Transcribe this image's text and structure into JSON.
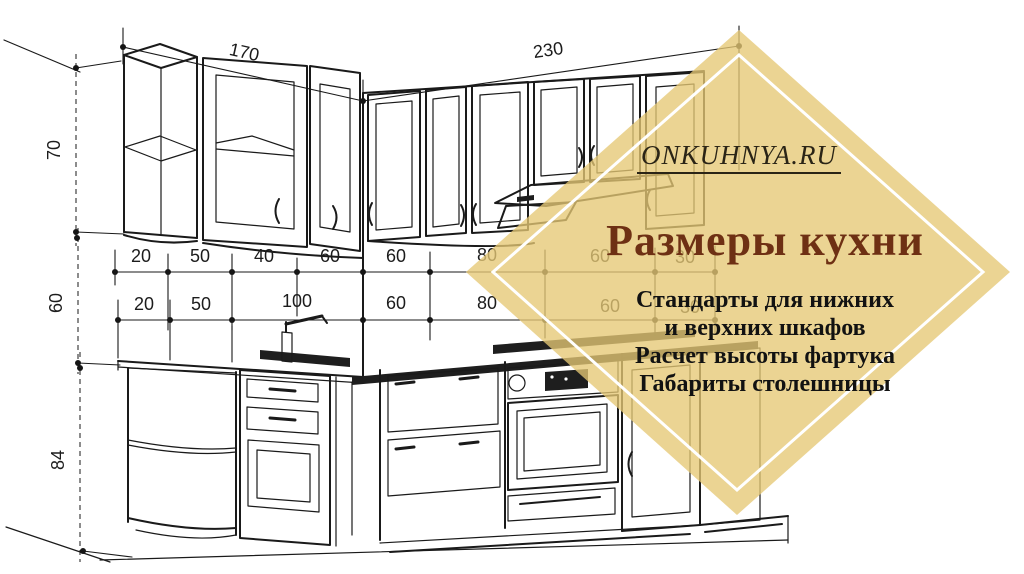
{
  "diagram": {
    "ink": "#1a1a1a",
    "top": [
      "170",
      "230"
    ],
    "left": [
      "70",
      "60",
      "84"
    ],
    "row_upper": [
      "20",
      "50",
      "40",
      "60",
      "60",
      "80",
      "60",
      "30"
    ],
    "row_lower": [
      "20",
      "50",
      "100",
      "60",
      "80",
      "60",
      "30"
    ]
  },
  "overlay": {
    "site": "ONKUHNYA.RU",
    "title": "Размеры кухни",
    "lines": [
      "Стандарты для нижних",
      "и верхних шкафов",
      "Расчет высоты фартука",
      "Габариты столешницы"
    ],
    "fill": "#e6c875",
    "fill_opacity": "0.78",
    "border": "#ffffff",
    "title_color": "#6e3014",
    "site_color": "#2a2416",
    "text_color": "#121212"
  }
}
